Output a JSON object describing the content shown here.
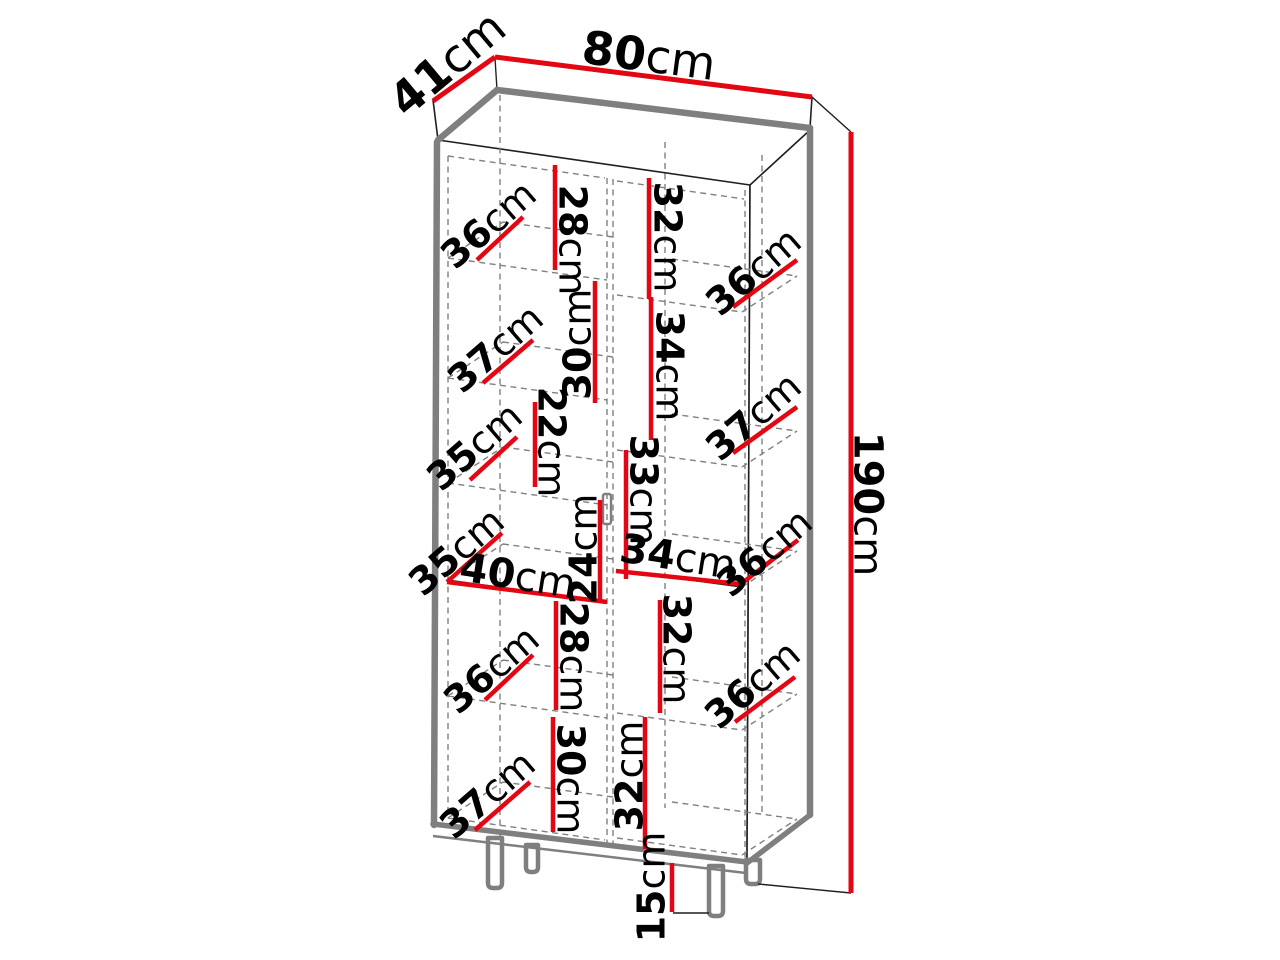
{
  "diagram": {
    "kind": "furniture-dimension-diagram",
    "unit": "cm",
    "colors": {
      "dimension_line": "#e30613",
      "outline": "#1f1f1f",
      "panel_gray": "#7f7f7f",
      "construction_gray": "#808080",
      "label_text": "#000000",
      "background": "#ffffff"
    },
    "dimensions": [
      {
        "id": "width-80",
        "value": "80",
        "unit": "cm",
        "line": [
          495,
          57,
          812,
          97
        ],
        "label": {
          "x": 649,
          "y": 55,
          "rot": 7.5
        },
        "size": 46,
        "lw": 5
      },
      {
        "id": "depth-41",
        "value": "41",
        "unit": "cm",
        "line": [
          433,
          101,
          495,
          57
        ],
        "label": {
          "x": 447,
          "y": 63,
          "rot": -40
        },
        "size": 46,
        "lw": 5
      },
      {
        "id": "height-190",
        "value": "190",
        "unit": "cm",
        "line": [
          851,
          132,
          851,
          893
        ],
        "label": {
          "x": 869,
          "y": 504,
          "rot": 90
        },
        "size": 40,
        "lw": 5
      },
      {
        "id": "shelf-28-row1-left",
        "value": "28",
        "unit": "cm",
        "line": [
          555,
          165,
          555,
          270
        ],
        "label": {
          "x": 573,
          "y": 240,
          "rot": 90
        },
        "size": 38,
        "lw": 4.5
      },
      {
        "id": "depth-36-row1-left",
        "value": "36",
        "unit": "cm",
        "line": [
          477,
          260,
          523,
          217
        ],
        "label": {
          "x": 488,
          "y": 224,
          "rot": -41
        },
        "size": 38,
        "lw": 4.5
      },
      {
        "id": "shelf-32-row1-right",
        "value": "32",
        "unit": "cm",
        "line": [
          649,
          178,
          649,
          299
        ],
        "label": {
          "x": 668,
          "y": 237,
          "rot": 90
        },
        "size": 38,
        "lw": 4.5
      },
      {
        "id": "depth-36-row1-right",
        "value": "36",
        "unit": "cm",
        "line": [
          733,
          307,
          797,
          260
        ],
        "label": {
          "x": 753,
          "y": 271,
          "rot": -41
        },
        "size": 38,
        "lw": 4.5
      },
      {
        "id": "shelf-30-row2-left",
        "value": "30",
        "unit": "cm",
        "line": [
          595,
          281,
          595,
          403
        ],
        "label": {
          "x": 577,
          "y": 344,
          "rot": -90
        },
        "size": 38,
        "lw": 4.5
      },
      {
        "id": "depth-37-row2-left",
        "value": "37",
        "unit": "cm",
        "line": [
          483,
          383,
          533,
          340
        ],
        "label": {
          "x": 495,
          "y": 348,
          "rot": -41
        },
        "size": 38,
        "lw": 4.5
      },
      {
        "id": "shelf-34-row2-right",
        "value": "34",
        "unit": "cm",
        "line": [
          651,
          297,
          651,
          440
        ],
        "label": {
          "x": 670,
          "y": 366,
          "rot": 90
        },
        "size": 38,
        "lw": 4.5
      },
      {
        "id": "depth-37-row2-right",
        "value": "37",
        "unit": "cm",
        "line": [
          733,
          453,
          797,
          407
        ],
        "label": {
          "x": 753,
          "y": 416,
          "rot": -41
        },
        "size": 38,
        "lw": 4.5
      },
      {
        "id": "shelf-22-row3-left",
        "value": "22",
        "unit": "cm",
        "line": [
          535,
          402,
          535,
          487
        ],
        "label": {
          "x": 552,
          "y": 442,
          "rot": 90
        },
        "size": 38,
        "lw": 4.5
      },
      {
        "id": "depth-35-row3-left",
        "value": "35",
        "unit": "cm",
        "line": [
          470,
          480,
          517,
          437
        ],
        "label": {
          "x": 474,
          "y": 446,
          "rot": -41
        },
        "size": 38,
        "lw": 4.5
      },
      {
        "id": "shelf-33-row3-right",
        "value": "33",
        "unit": "cm",
        "line": [
          626,
          450,
          626,
          579
        ],
        "label": {
          "x": 644,
          "y": 490,
          "rot": 90
        },
        "size": 38,
        "lw": 4.5
      },
      {
        "id": "depth-35-mid-left",
        "value": "35",
        "unit": "cm",
        "line": [
          447,
          582,
          502,
          533
        ],
        "label": {
          "x": 456,
          "y": 551,
          "rot": -41
        },
        "size": 38,
        "lw": 4.5
      },
      {
        "id": "width-40-mid-left",
        "value": "40",
        "unit": "cm",
        "line": [
          447,
          582,
          607,
          602
        ],
        "label": {
          "x": 518,
          "y": 575,
          "rot": 9
        },
        "size": 40,
        "lw": 4.5
      },
      {
        "id": "shelf-24-row4-left",
        "value": "24",
        "unit": "cm",
        "line": [
          600,
          500,
          600,
          602
        ],
        "label": {
          "x": 583,
          "y": 549,
          "rot": -90
        },
        "size": 38,
        "lw": 4.5
      },
      {
        "id": "width-34-mid-right",
        "value": "34",
        "unit": "cm",
        "line": [
          616,
          571,
          740,
          584
        ],
        "label": {
          "x": 678,
          "y": 556,
          "rot": 9
        },
        "size": 40,
        "lw": 4.5
      },
      {
        "id": "depth-36-mid-right",
        "value": "36",
        "unit": "cm",
        "line": [
          737,
          587,
          798,
          540
        ],
        "label": {
          "x": 764,
          "y": 552,
          "rot": -41
        },
        "size": 38,
        "lw": 4.5
      },
      {
        "id": "shelf-28-row5-left",
        "value": "28",
        "unit": "cm",
        "line": [
          556,
          601,
          556,
          710
        ],
        "label": {
          "x": 574,
          "y": 657,
          "rot": 90
        },
        "size": 38,
        "lw": 4.5
      },
      {
        "id": "depth-36-row5-left",
        "value": "36",
        "unit": "cm",
        "line": [
          485,
          700,
          533,
          655
        ],
        "label": {
          "x": 491,
          "y": 669,
          "rot": -41
        },
        "size": 38,
        "lw": 4.5
      },
      {
        "id": "shelf-32-row5-right",
        "value": "32",
        "unit": "cm",
        "line": [
          660,
          600,
          660,
          713
        ],
        "label": {
          "x": 677,
          "y": 649,
          "rot": 90
        },
        "size": 38,
        "lw": 4.5
      },
      {
        "id": "depth-36-row5-right",
        "value": "36",
        "unit": "cm",
        "line": [
          735,
          722,
          795,
          677
        ],
        "label": {
          "x": 752,
          "y": 684,
          "rot": -41
        },
        "size": 38,
        "lw": 4.5
      },
      {
        "id": "shelf-30-row6-left",
        "value": "30",
        "unit": "cm",
        "line": [
          553,
          717,
          553,
          832
        ],
        "label": {
          "x": 571,
          "y": 779,
          "rot": 90
        },
        "size": 38,
        "lw": 4.5
      },
      {
        "id": "shelf-32-row6-right",
        "value": "32",
        "unit": "cm",
        "line": [
          645,
          717,
          645,
          849
        ],
        "label": {
          "x": 629,
          "y": 776,
          "rot": -90
        },
        "size": 38,
        "lw": 4.5
      },
      {
        "id": "depth-37-row6-left",
        "value": "37",
        "unit": "cm",
        "line": [
          475,
          830,
          530,
          782
        ],
        "label": {
          "x": 487,
          "y": 794,
          "rot": -41
        },
        "size": 38,
        "lw": 4.5
      },
      {
        "id": "legs-height-15",
        "value": "15",
        "unit": "cm",
        "line": [
          672,
          863,
          672,
          912
        ],
        "label": {
          "x": 651,
          "y": 887,
          "rot": -90
        },
        "size": 38,
        "lw": 4.5
      }
    ]
  }
}
